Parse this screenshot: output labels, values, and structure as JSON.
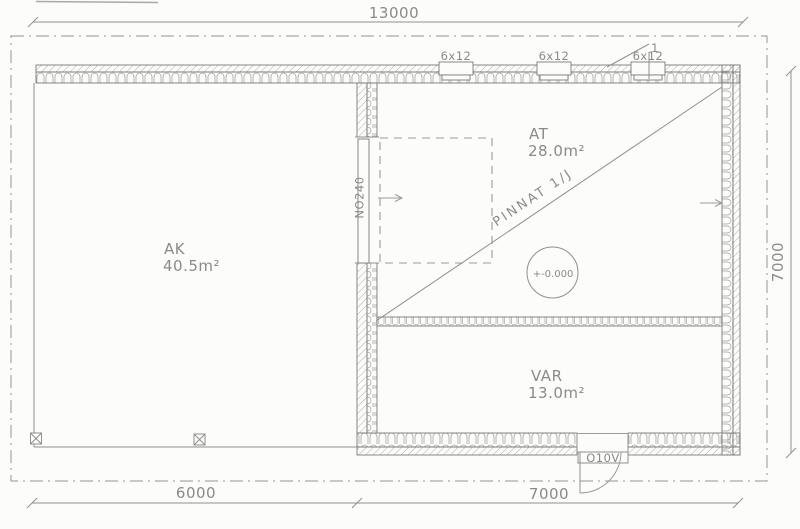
{
  "plan": {
    "dimensions": {
      "top": "13000",
      "bottom_left": "6000",
      "bottom_right": "7000",
      "right": "7000"
    },
    "rooms": [
      {
        "name": "AK",
        "area": "40.5m²"
      },
      {
        "name": "AT",
        "area": "28.0m²"
      },
      {
        "name": "VAR",
        "area": "13.0m²"
      }
    ],
    "window_labels": [
      "6x12",
      "6x12",
      "6x12"
    ],
    "doors": {
      "garage": "NO240",
      "entry": "O10V"
    },
    "annotations": {
      "surface_note": "PINNAT 1/J",
      "level": "+-0.000",
      "detail_ref": "1"
    },
    "colors": {
      "line": "#8f8f8f",
      "text": "#8a8a8a",
      "hatch": "#a6a6a6",
      "background": "#fcfcfb"
    }
  }
}
